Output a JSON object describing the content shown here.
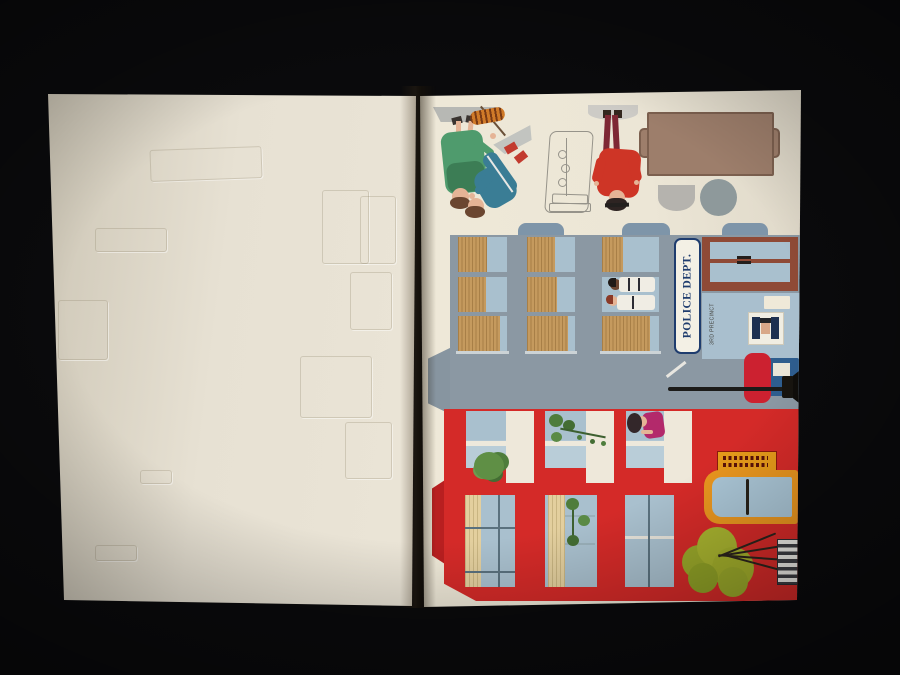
{
  "photo": {
    "subject": "Open punch-out paper-model book photographed on a black background",
    "left_page": "blank cream page with faint embossed die-cut outlines",
    "right_page": "printed punch-out sheet with figures, furniture tops, a police station front and a red shop front (pieces printed rotated)"
  },
  "police_building": {
    "sign_label": "POLICE DEPT.",
    "precinct_label": "3RD PRECINCT"
  },
  "pieces": {
    "figures": [
      "woman-green-coat",
      "person-blue-tracksuit",
      "person-red-coat",
      "two-officers-in-window",
      "woman-in-upper-window"
    ],
    "furniture": [
      "rectangular-table-top",
      "half-round-table-top",
      "round-table-top",
      "stand-outline"
    ],
    "street_items": [
      "street-lamp",
      "police-call-box",
      "mail-box",
      "bush",
      "white-grate",
      "shop-sign",
      "potted-plants"
    ]
  },
  "colors": {
    "bg": "#0a0a0c",
    "police-grey": "#8b98a3",
    "police-tab": "#7e95a9",
    "glass": "#a9c0ce",
    "glass-light": "#b9cdd8",
    "blind": "#c59a5e",
    "blind-dark": "#a87f47",
    "blind-cream": "#e3cf9e",
    "sign-bg": "#f3f0e5",
    "navy": "#1e3c6e",
    "door-brown": "#8f4a36",
    "wall-blue": "#a9bfce",
    "box-red": "#cc2130",
    "box-blue": "#2e5d8e",
    "red": "#d42a28",
    "red-deep": "#b81f20",
    "panel-cream": "#eee8da",
    "orange": "#e8951f",
    "sign-orange": "#e59a1a",
    "bush": "#a8b32f",
    "leaf": "#4e7d3c",
    "table-brown": "#9d7e6b",
    "table-edge": "#7c604f",
    "base-grey": "#b7b8b4",
    "round-grey": "#8e999b",
    "fig-green": "#4f9b6d",
    "fig-green-dark": "#3c7d55",
    "fig-teal": "#3a7d95",
    "fig-red": "#ce3526",
    "maroon": "#7e2734",
    "skin": "#e5b496",
    "hair-brown": "#6b4630",
    "hair-dark": "#2e2422"
  }
}
